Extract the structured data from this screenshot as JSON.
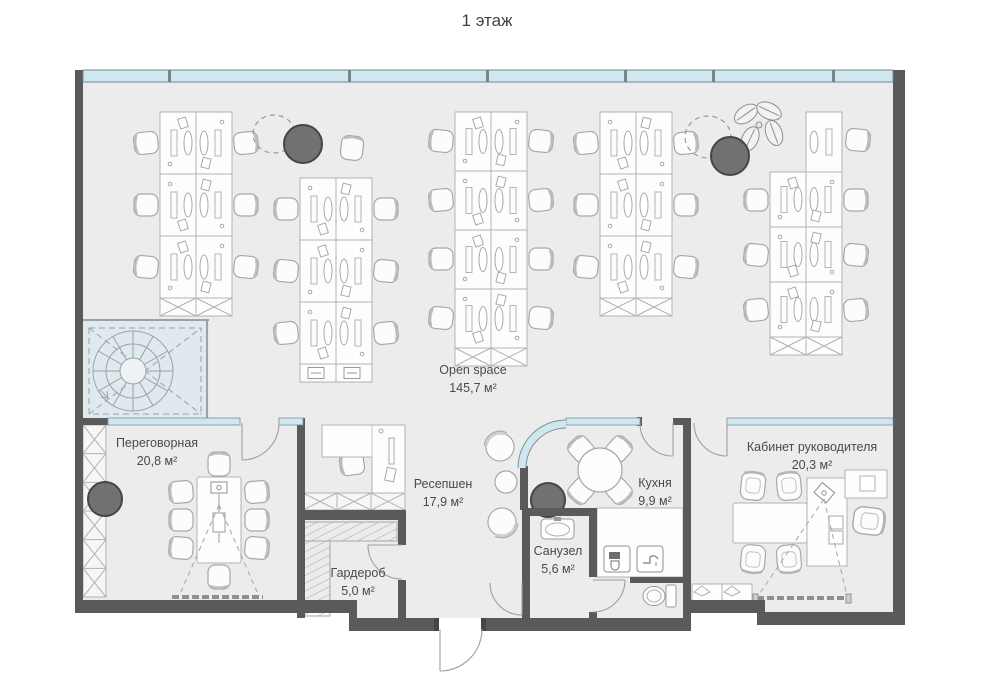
{
  "title": "1 этаж",
  "rooms": {
    "open_space": {
      "name": "Open space",
      "area": "145,7 м²"
    },
    "meeting": {
      "name": "Переговорная",
      "area": "20,8 м²"
    },
    "reception": {
      "name": "Ресепшен",
      "area": "17,9 м²"
    },
    "wardrobe": {
      "name": "Гардероб",
      "area": "5,0 м²"
    },
    "kitchen": {
      "name": "Кухня",
      "area": "9,9 м²"
    },
    "bathroom": {
      "name": "Санузел",
      "area": "5,6 м²"
    },
    "director_office": {
      "name": "Кабинет руководителя",
      "area": "20,3 м²"
    }
  },
  "colors": {
    "wall": "#5a5a5a",
    "floor": "#ececec",
    "glass": "#cfe7f1",
    "stair_room": "#dfe9ee",
    "column": "#717171",
    "furniture_stroke": "#b2b2b2",
    "text": "#4a4a4a"
  },
  "icons": {
    "coffee_machine": "coffee-machine-icon",
    "tap": "tap-icon",
    "toilet": "toilet-icon",
    "sink": "sink-icon",
    "plant": "plant-icon",
    "spiral_stairs": "spiral-stairs-icon",
    "projector": "projector-icon",
    "printer": "printer-icon"
  }
}
